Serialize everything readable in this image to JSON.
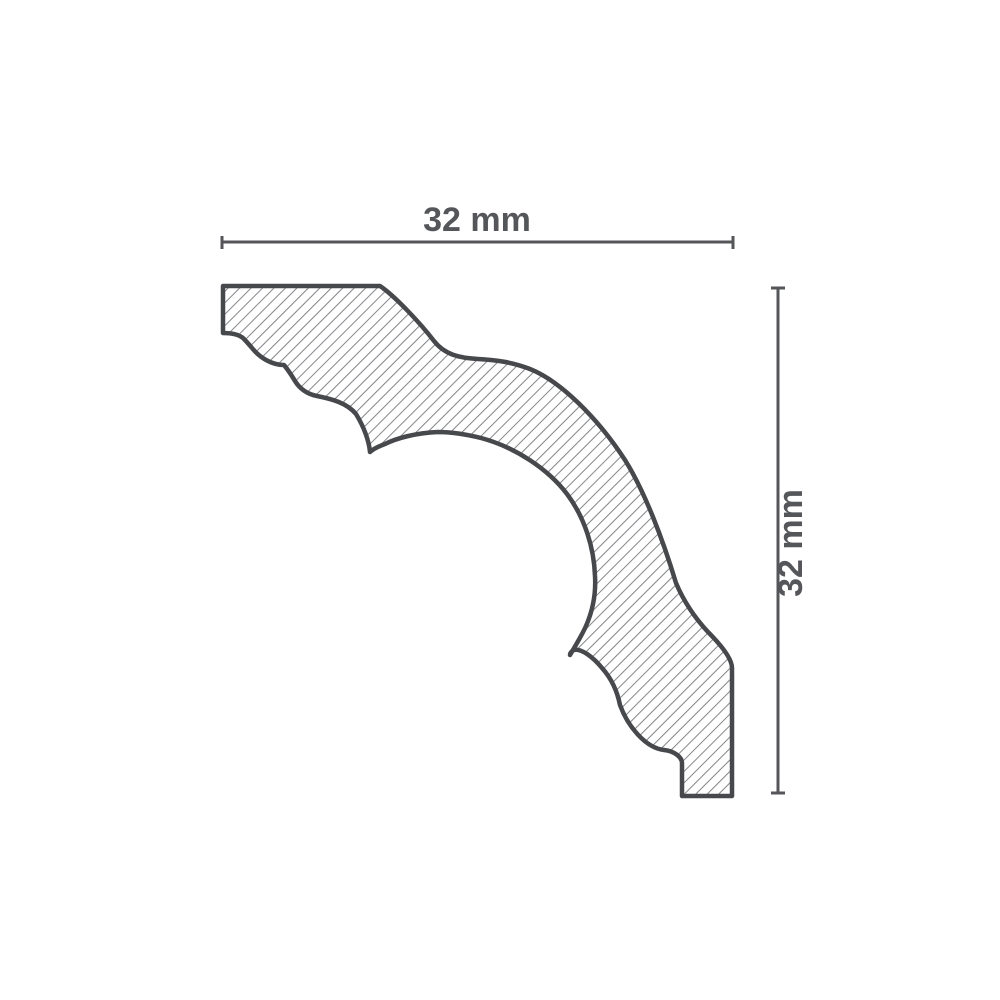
{
  "figure": {
    "kind": "profile-cross-section-drawing"
  },
  "dimensions": {
    "width": {
      "label": "32 mm",
      "value": 32,
      "unit": "mm"
    },
    "height": {
      "label": "32 mm",
      "value": 32,
      "unit": "mm"
    }
  },
  "colors": {
    "outline": "#46484b",
    "hatch": "#828487",
    "dimension": "#54565a",
    "label": "#54565a",
    "background": "#ffffff"
  }
}
